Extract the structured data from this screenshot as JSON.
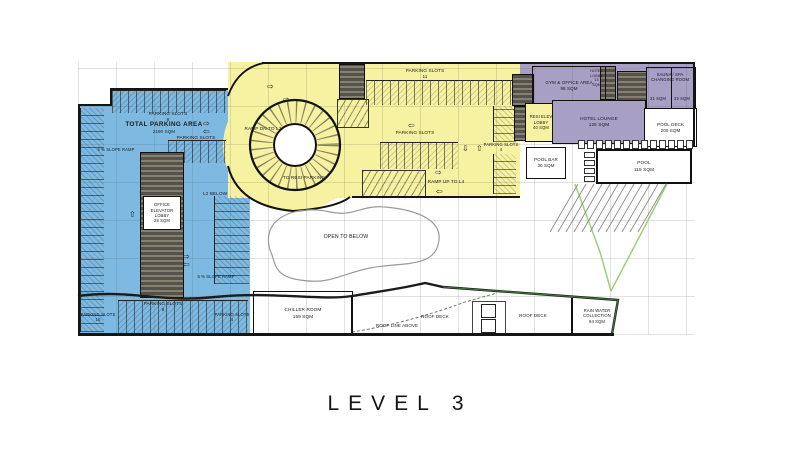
{
  "title": "LEVEL 3",
  "colors": {
    "parking_blue": "#7db9e1",
    "ramp_yellow": "#f6f2a2",
    "amenity_purple": "#a89fc5",
    "core_dark": "#54524b",
    "wall_black": "#151515",
    "boundary_green": "#9fcd7e"
  },
  "icons": {
    "arrow_left": "⇦",
    "arrow_right": "⇨",
    "arrow_up": "⇧",
    "arrow_down": "⇩"
  },
  "labels": {
    "parking_slots": "PARKING SLOTS",
    "slope_ramp": "5 % SLOPE RAMP",
    "total_parking_title": "TOTAL PARKING AREA",
    "total_parking_area": "2190 SQM",
    "counts": {
      "blue_top": "8",
      "blue_bottom_left": "10",
      "blue_bottom_mid": "8",
      "blue_bottom_right": "4",
      "yellow_top": "11",
      "yellow_right": "4"
    },
    "ramp_dn": "RAMP DN TO L2",
    "ramp_up": "RAMP UP TO L4",
    "to_resi": "TO RESI PARKING",
    "l2_below": "L2 BELOW",
    "open_to_below": "OPEN TO BELOW",
    "roof_line_above": "ROOF LINE ABOVE",
    "roof_deck": "ROOF DECK"
  },
  "rooms": {
    "office_elev": {
      "name": "OFFICE ELEVATOR LOBBY",
      "area": "28 SQM"
    },
    "gym": {
      "name": "GYM & OFFICE AREA",
      "area": "98 SQM"
    },
    "resi_elev": {
      "name": "RESI ELEV LOBBY",
      "area": "40 SQM"
    },
    "hotel_lobby": {
      "name": "HOTEL LOBBY",
      "area": "13 SQM"
    },
    "sauna": {
      "name": "SAUNA / SPA CHANGING ROOM",
      "area_left": "31 SQM",
      "area_right": "32 SQM"
    },
    "hotel_lounge": {
      "name": "HOTEL LOUNGE",
      "area": "125 SQM"
    },
    "pool_deck": {
      "name": "POOL DECK",
      "area": "200 SQM"
    },
    "pool_bar": {
      "name": "POOL BAR",
      "area": "30 SQM"
    },
    "pool": {
      "name": "POOL",
      "area": "115 SQM"
    },
    "chiller": {
      "name": "CHILLER ROOM",
      "area": "159 SQM"
    },
    "rain_water": {
      "name": "RAIN WATER COLLECTION",
      "area": "94 SQM"
    }
  }
}
